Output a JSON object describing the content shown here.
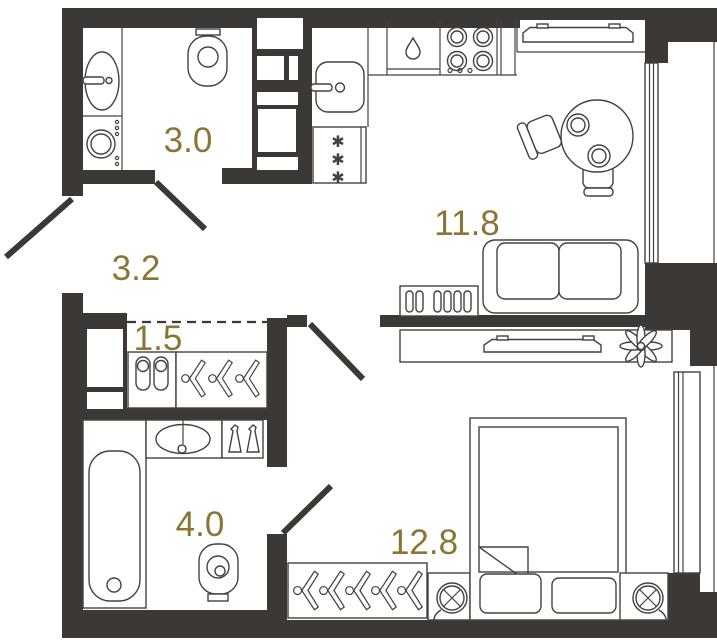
{
  "floorplan": {
    "type": "apartment-floor-plan",
    "colors": {
      "walls": "#3c3835",
      "fixture_lines": "#45413e",
      "room_labels": "#8c7436",
      "background": "#ffffff"
    },
    "rooms": [
      {
        "name": "bathroom-top",
        "area_label": "3.0",
        "fixtures": [
          "sink-icon",
          "washing-machine-icon",
          "toilet-icon",
          "door-swing-icon"
        ]
      },
      {
        "name": "hallway",
        "area_label": "3.2",
        "fixtures": [
          "entrance-door-swing-icon"
        ]
      },
      {
        "name": "closet",
        "area_label": "1.5",
        "fixtures": [
          "slippers-icon",
          "hangers-icon",
          "dashed-boundary"
        ]
      },
      {
        "name": "kitchen-living-room",
        "area_label": "11.8",
        "fixtures": [
          "kitchen-sink-icon",
          "fridge-snowflakes-icon",
          "dishwasher-drop-icon",
          "stove-burners-icon",
          "radiator-icon",
          "dining-table-icon",
          "chair-icon",
          "sofa-icon",
          "console-icon",
          "window-icon"
        ]
      },
      {
        "name": "bathroom-bottom",
        "area_label": "4.0",
        "fixtures": [
          "bathtub-icon",
          "sink-icon",
          "bottles-icon",
          "toilet-icon",
          "door-swing-icon"
        ]
      },
      {
        "name": "bedroom",
        "area_label": "12.8",
        "fixtures": [
          "wardrobe-hangers-icon",
          "bed-icon",
          "pillow-icon",
          "nightstand-lamp-icon",
          "tv-icon",
          "plant-icon",
          "window-icon",
          "door-swing-icon"
        ]
      }
    ]
  }
}
